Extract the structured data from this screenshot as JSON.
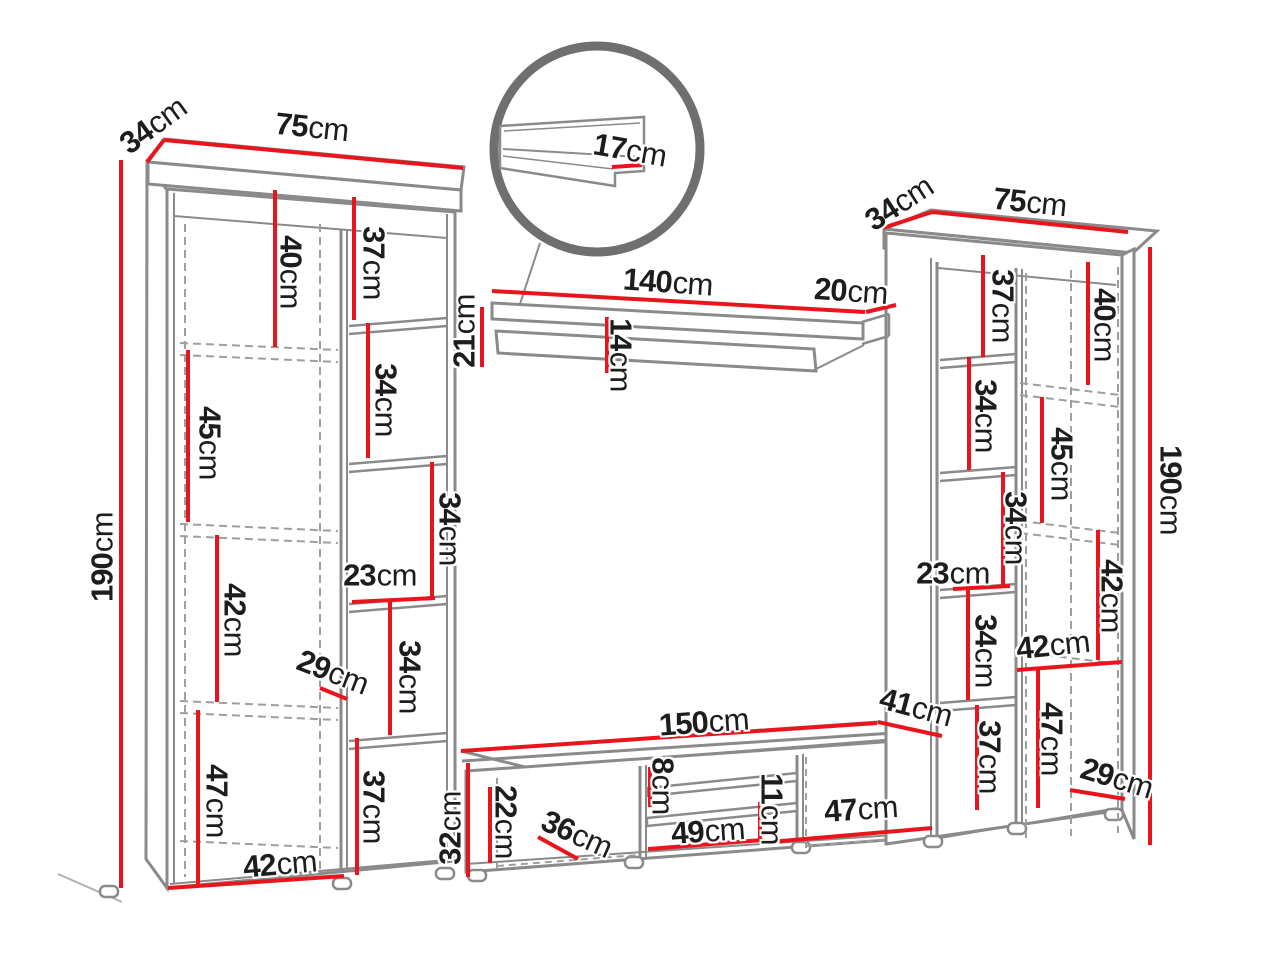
{
  "colors": {
    "accent_red": "#e9151d",
    "outline_gray": "#8a8a8a",
    "text": "#1d1d1b"
  },
  "detail_circle": {
    "lip_length": {
      "v": "17",
      "u": "cm"
    }
  },
  "wall_shelf": {
    "width": {
      "v": "140",
      "u": "cm"
    },
    "depth": {
      "v": "20",
      "u": "cm"
    },
    "side_height": {
      "v": "21",
      "u": "cm"
    },
    "front_height": {
      "v": "14",
      "u": "cm"
    }
  },
  "left_cabinet": {
    "depth": {
      "v": "34",
      "u": "cm"
    },
    "width": {
      "v": "75",
      "u": "cm"
    },
    "height": {
      "v": "190",
      "u": "cm"
    },
    "door": {
      "c1": {
        "v": "40",
        "u": "cm"
      },
      "c2": {
        "v": "45",
        "u": "cm"
      },
      "c3": {
        "v": "42",
        "u": "cm"
      },
      "c4": {
        "v": "47",
        "u": "cm"
      },
      "width": {
        "v": "42",
        "u": "cm"
      }
    },
    "shelves": {
      "s1": {
        "v": "37",
        "u": "cm"
      },
      "s2": {
        "v": "34",
        "u": "cm"
      },
      "s3": {
        "v": "34",
        "u": "cm"
      },
      "width": {
        "v": "23",
        "u": "cm"
      },
      "s4": {
        "v": "34",
        "u": "cm"
      },
      "s5": {
        "v": "37",
        "u": "cm"
      }
    },
    "door_depth": {
      "v": "29",
      "u": "cm"
    }
  },
  "right_cabinet": {
    "depth": {
      "v": "34",
      "u": "cm"
    },
    "width": {
      "v": "75",
      "u": "cm"
    },
    "height": {
      "v": "190",
      "u": "cm"
    },
    "shelves": {
      "s1": {
        "v": "37",
        "u": "cm"
      },
      "s2": {
        "v": "34",
        "u": "cm"
      },
      "s3": {
        "v": "34",
        "u": "cm"
      },
      "width": {
        "v": "23",
        "u": "cm"
      },
      "s4": {
        "v": "34",
        "u": "cm"
      },
      "s5": {
        "v": "37",
        "u": "cm"
      }
    },
    "door": {
      "c1": {
        "v": "40",
        "u": "cm"
      },
      "c2": {
        "v": "45",
        "u": "cm"
      },
      "c3": {
        "v": "42",
        "u": "cm"
      },
      "width": {
        "v": "42",
        "u": "cm"
      },
      "c4": {
        "v": "47",
        "u": "cm"
      }
    },
    "base_depth": {
      "v": "29",
      "u": "cm"
    }
  },
  "tv_stand": {
    "width": {
      "v": "150",
      "u": "cm"
    },
    "depth": {
      "v": "41",
      "u": "cm"
    },
    "opening_height": {
      "v": "22",
      "u": "cm"
    },
    "height": {
      "v": "32",
      "u": "cm"
    },
    "left_opening_width": {
      "v": "36",
      "u": "cm"
    },
    "top_shelf_gap": {
      "v": "8",
      "u": "cm"
    },
    "center_width": {
      "v": "49",
      "u": "cm"
    },
    "bottom_shelf_gap": {
      "v": "11",
      "u": "cm"
    },
    "right_opening_width": {
      "v": "47",
      "u": "cm"
    }
  }
}
